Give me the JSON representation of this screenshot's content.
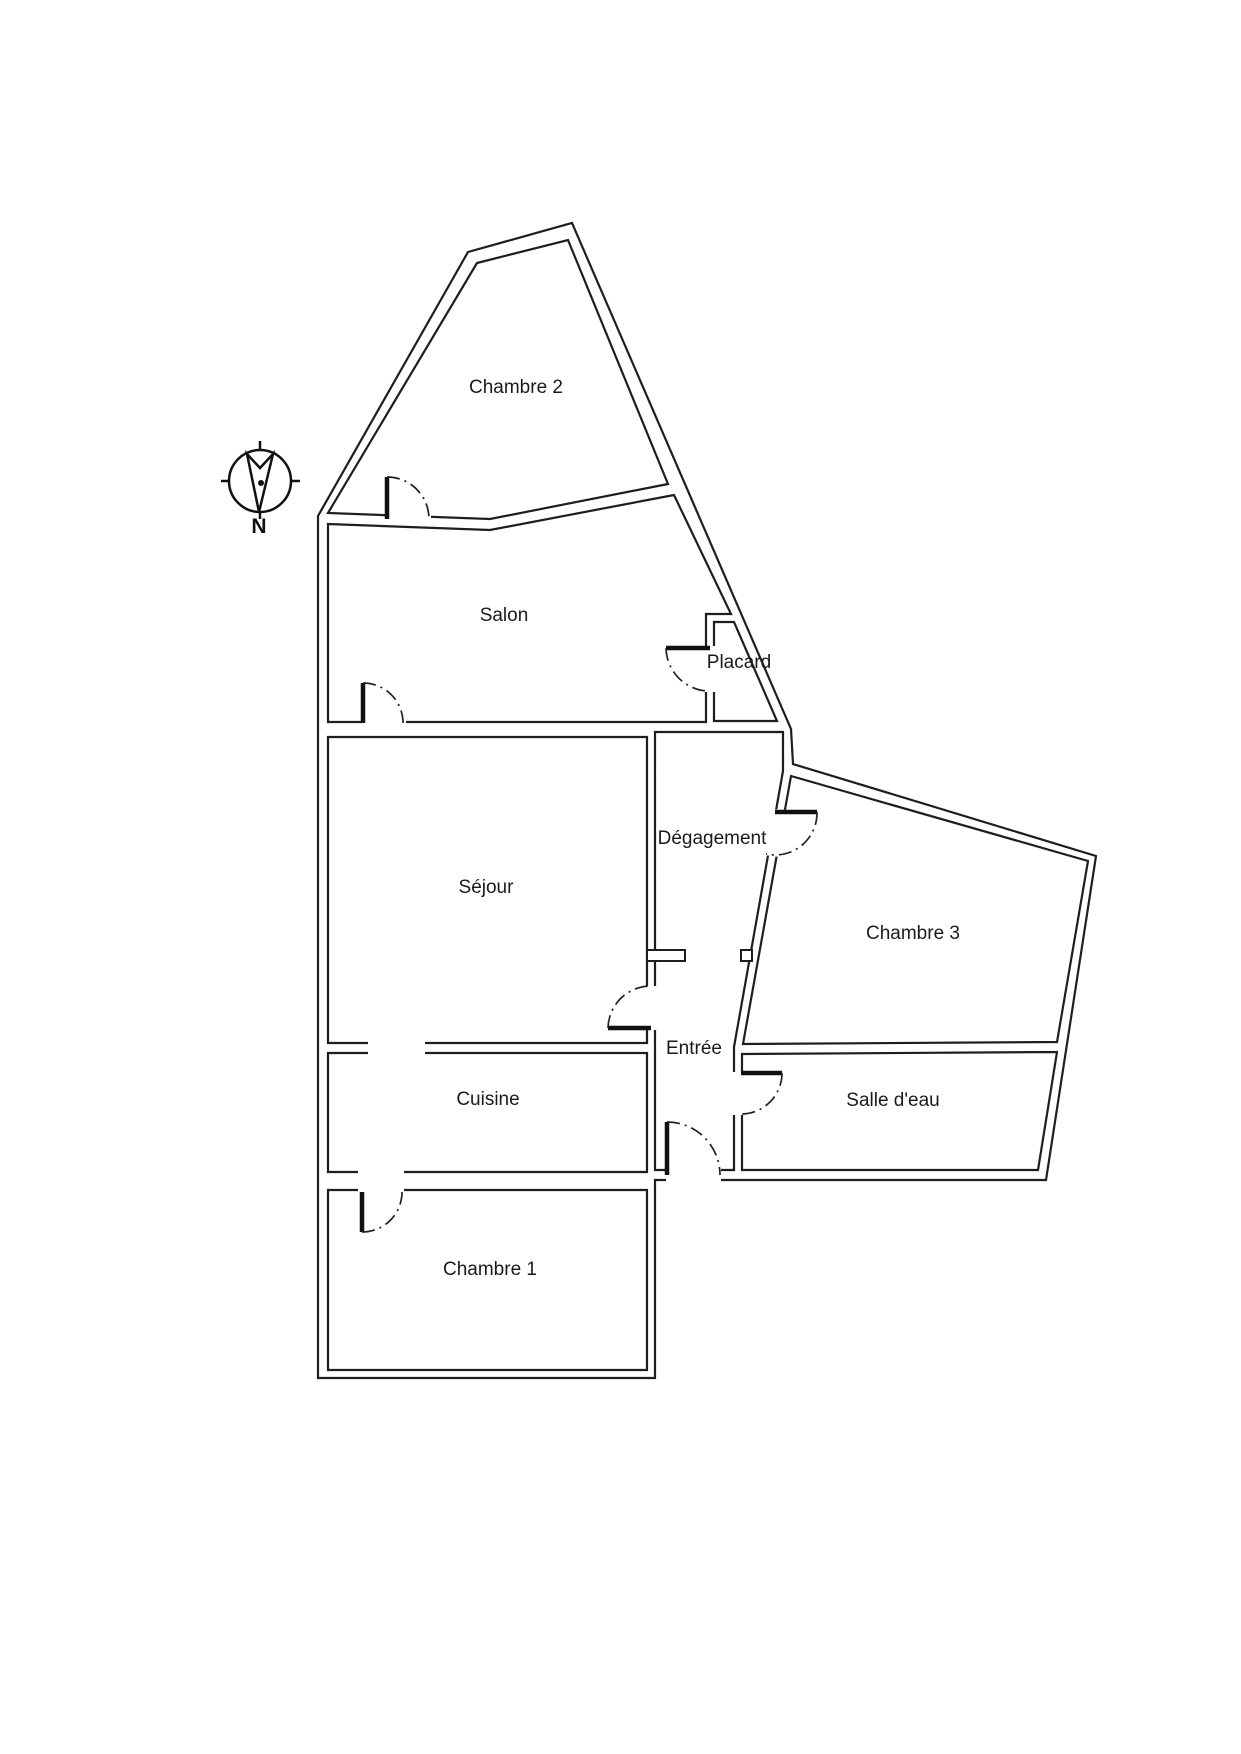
{
  "rooms": {
    "chambre2": "Chambre 2",
    "salon": "Salon",
    "placard": "Placard",
    "degagement": "Dégagement",
    "sejour": "Séjour",
    "chambre3": "Chambre 3",
    "entree": "Entrée",
    "cuisine": "Cuisine",
    "salledeau": "Salle d'eau",
    "chambre1": "Chambre 1"
  },
  "compass": {
    "north": "N"
  },
  "colors": {
    "wall": "#1e1e1e",
    "background": "#ffffff",
    "text": "#1a1a1a"
  }
}
